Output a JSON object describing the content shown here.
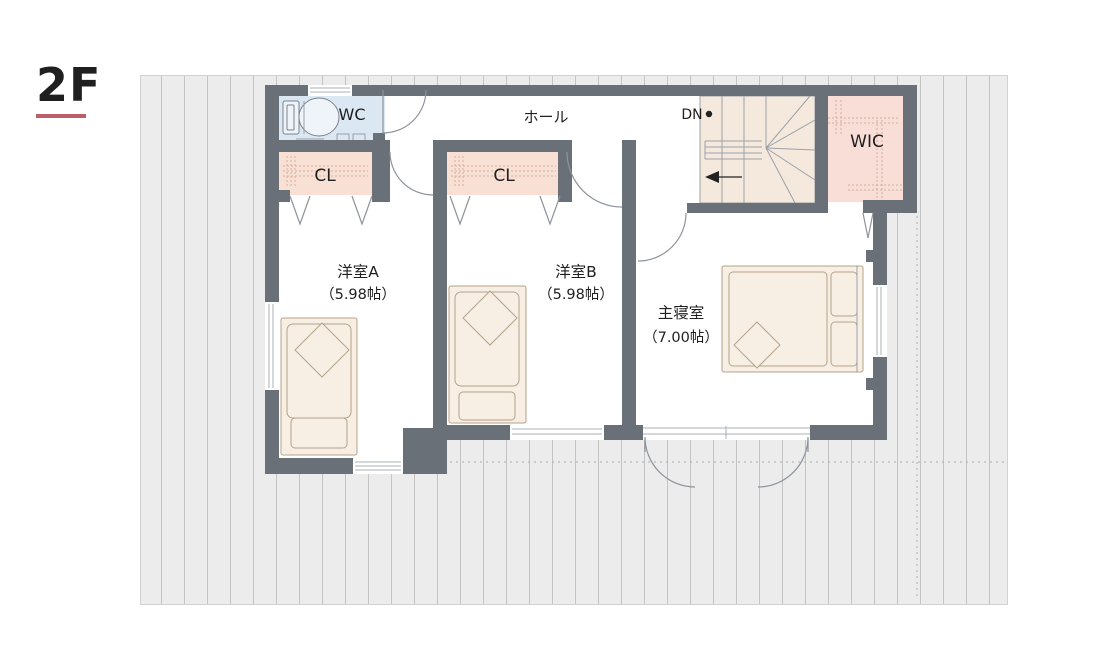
{
  "floor": {
    "label": "2F"
  },
  "rooms": {
    "wc": {
      "label": "WC"
    },
    "closet_a": {
      "label": "CL"
    },
    "closet_b": {
      "label": "CL"
    },
    "hall": {
      "label": "ホール"
    },
    "stairs": {
      "label": "DN"
    },
    "wic": {
      "label": "WIC"
    },
    "bedroom_a": {
      "label": "洋室A",
      "area": "（5.98帖）"
    },
    "bedroom_b": {
      "label": "洋室B",
      "area": "（5.98帖）"
    },
    "master": {
      "label": "主寝室",
      "area": "（7.00帖）"
    }
  },
  "colors": {
    "page_bg": "#ffffff",
    "wall": "#6a7078",
    "wc_fill": "#dbe7f3",
    "closet_fill": "#f8e0d4",
    "wic_fill": "#f8ded6",
    "stairs_fill": "#f4e9dc",
    "bed_fill": "#f7efe3",
    "bed_stroke": "#b5a28a",
    "roof_fill": "#ececec",
    "roof_stripe": "#c3c3c3",
    "accent_underline": "#bb6069",
    "text": "#1f1f1f"
  }
}
